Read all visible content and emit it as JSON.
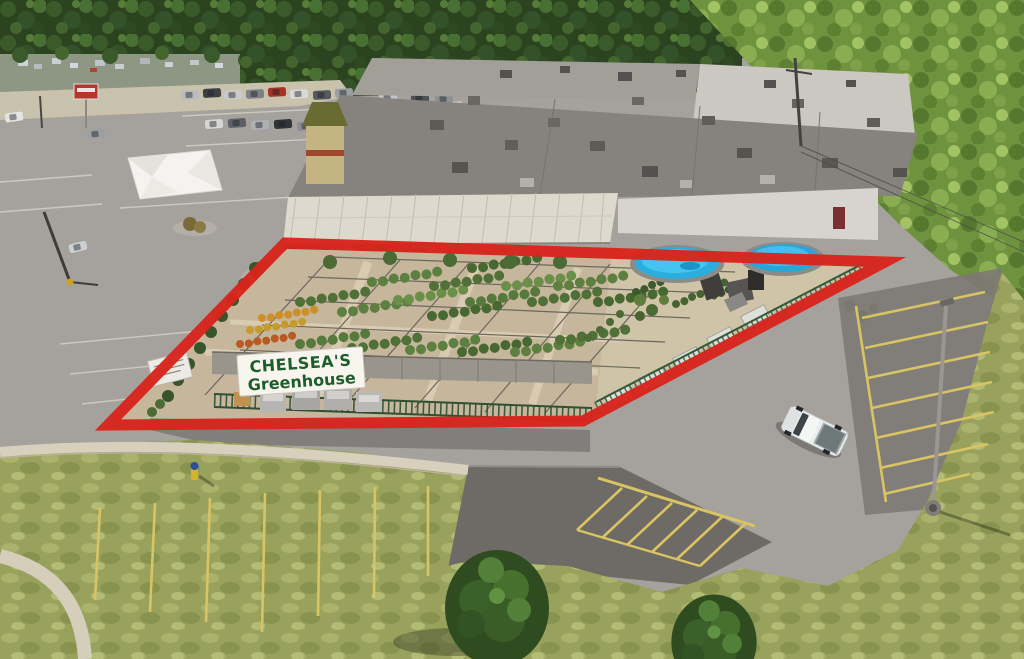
{
  "scene": {
    "type": "aerial-drone-photograph",
    "subject": "Retail plaza and parking lots with a garden-center parcel highlighted by a red outline",
    "time_of_day": "daytime"
  },
  "annotation": {
    "outline_color": "#d8251d",
    "outline_shape": "quadrilateral"
  },
  "signs": {
    "greenhouse": {
      "line1": "CHELSEA'S",
      "line2": "Greenhouse",
      "text_color": "#1d5c2b",
      "panel_color": "#f7f5ee"
    }
  },
  "objects": {
    "pools": {
      "count": 2,
      "water_color": "#29aede"
    },
    "pickup_truck": {
      "color": "white"
    },
    "event_tent": {
      "color": "white"
    },
    "fire_hydrant": {
      "colors": [
        "yellow",
        "blue"
      ]
    },
    "reader_board_sign": {
      "text_legible": false
    },
    "parking_line_colors": {
      "upper_lot": "white",
      "lower_lot": "yellow"
    }
  },
  "palette": {
    "asphalt_light": "#a5a19c",
    "asphalt_dark": "#6e6a65",
    "roof": "#86837e",
    "dirt": "#c6b69c",
    "grass": "#99a25c",
    "forest": "#2b431f",
    "hillside": "#6f923f"
  }
}
